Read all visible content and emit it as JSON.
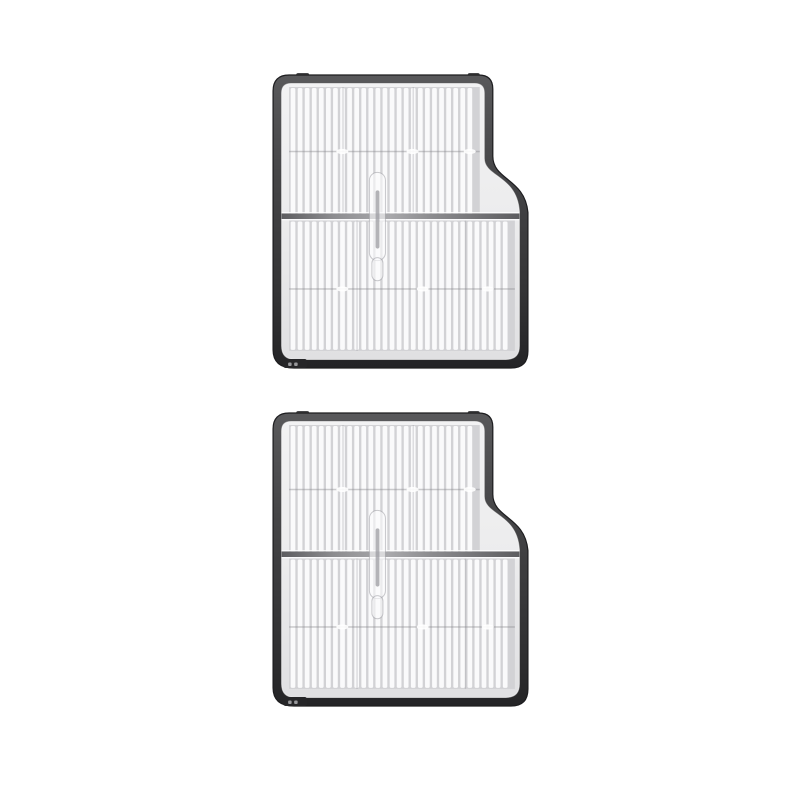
{
  "scene": {
    "type": "product-photo",
    "description": "Two identical pleated HEPA filter replacement parts with dark grey plastic frames, stacked vertically on a plain white background",
    "item_count": 2,
    "background": "#ffffff"
  },
  "items": [
    {
      "id": "filter-1",
      "name": "HEPA filter",
      "position": "top"
    },
    {
      "id": "filter-2",
      "name": "HEPA filter",
      "position": "bottom"
    }
  ],
  "colors": {
    "background": "#ffffff",
    "frame_top": "#59595b",
    "frame_mid": "#454547",
    "frame_low": "#333335",
    "frame_bottom": "#242426",
    "frame_edge": "#1d1d1f",
    "frame_tab": "#48484a",
    "tray_light": "#f2f2f3",
    "tray_mid": "#ececed",
    "tray_dark": "#e0e0e2",
    "inner_rim": "rgba(255,255,255,0.55)",
    "pleat_ridge": "#fafafb",
    "pleat_groove": "#d2d2d5",
    "seam_line": "rgba(130,130,136,0.4)",
    "seam_dot": "rgba(255,255,255,0.9)",
    "vertical_seam": "rgba(140,140,146,0.28)",
    "divider_dark": "#5d5d60",
    "divider_mid": "#8d8d90",
    "divider_light": "#a9a9ac",
    "divider_glint": "rgba(255,255,255,0.85)",
    "clip_fill": "rgba(252,252,253,0.6)",
    "clip_stroke": "rgba(150,150,156,0.5)",
    "clip_rod": "#9b9ba0",
    "latch_body": "#262628",
    "latch_tick": "#98989b"
  },
  "geometry": {
    "pleat_pitch": 7.05,
    "ridge_width": 4.7,
    "upper_block": {
      "x": 17,
      "y": 13,
      "w": 190,
      "h": 128
    },
    "lower_block": {
      "x": 17,
      "y": 146,
      "w": 225,
      "h": 130
    },
    "divider": {
      "x": 9.5,
      "y": 139,
      "w": 237,
      "h": 5.5
    },
    "seams": {
      "upper_y": 76.5,
      "lower_y": 213.5,
      "upper_dots": [
        70,
        140,
        197
      ],
      "lower_dots": [
        70,
        150,
        215
      ]
    },
    "vertical_seams": {
      "upper": [
        70,
        140
      ],
      "lower": [
        84,
        192
      ]
    }
  }
}
